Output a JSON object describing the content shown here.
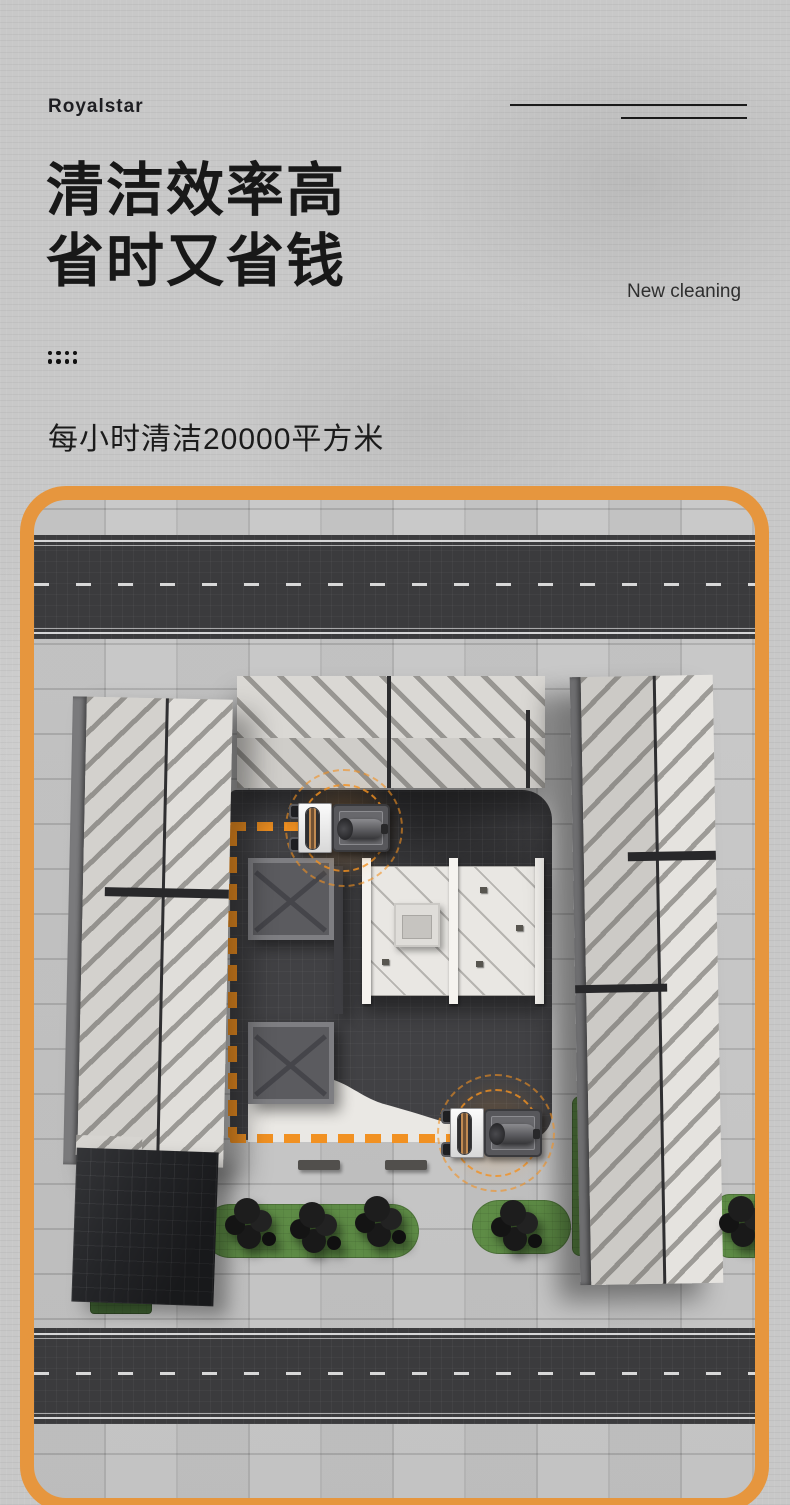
{
  "brand": {
    "logo": "Royalstar"
  },
  "hero": {
    "title_line1": "清洁效率高",
    "title_line2": "省时又省钱",
    "tagline": "New cleaning",
    "subtitle": "每小时清洁20000平方米"
  },
  "colors": {
    "frame_orange": "#E6963E",
    "route_orange": "#F19122",
    "road_asphalt": "#3B3B3D",
    "plaza_dark": "#414144",
    "pavement_gray": "#C6C6C6",
    "greenery": "#5E8C46",
    "headline_text": "#181818"
  },
  "scene": {
    "name": "aerial-cleaning-demo",
    "machine_count": 2,
    "route_style": "dashed-rectangle"
  }
}
